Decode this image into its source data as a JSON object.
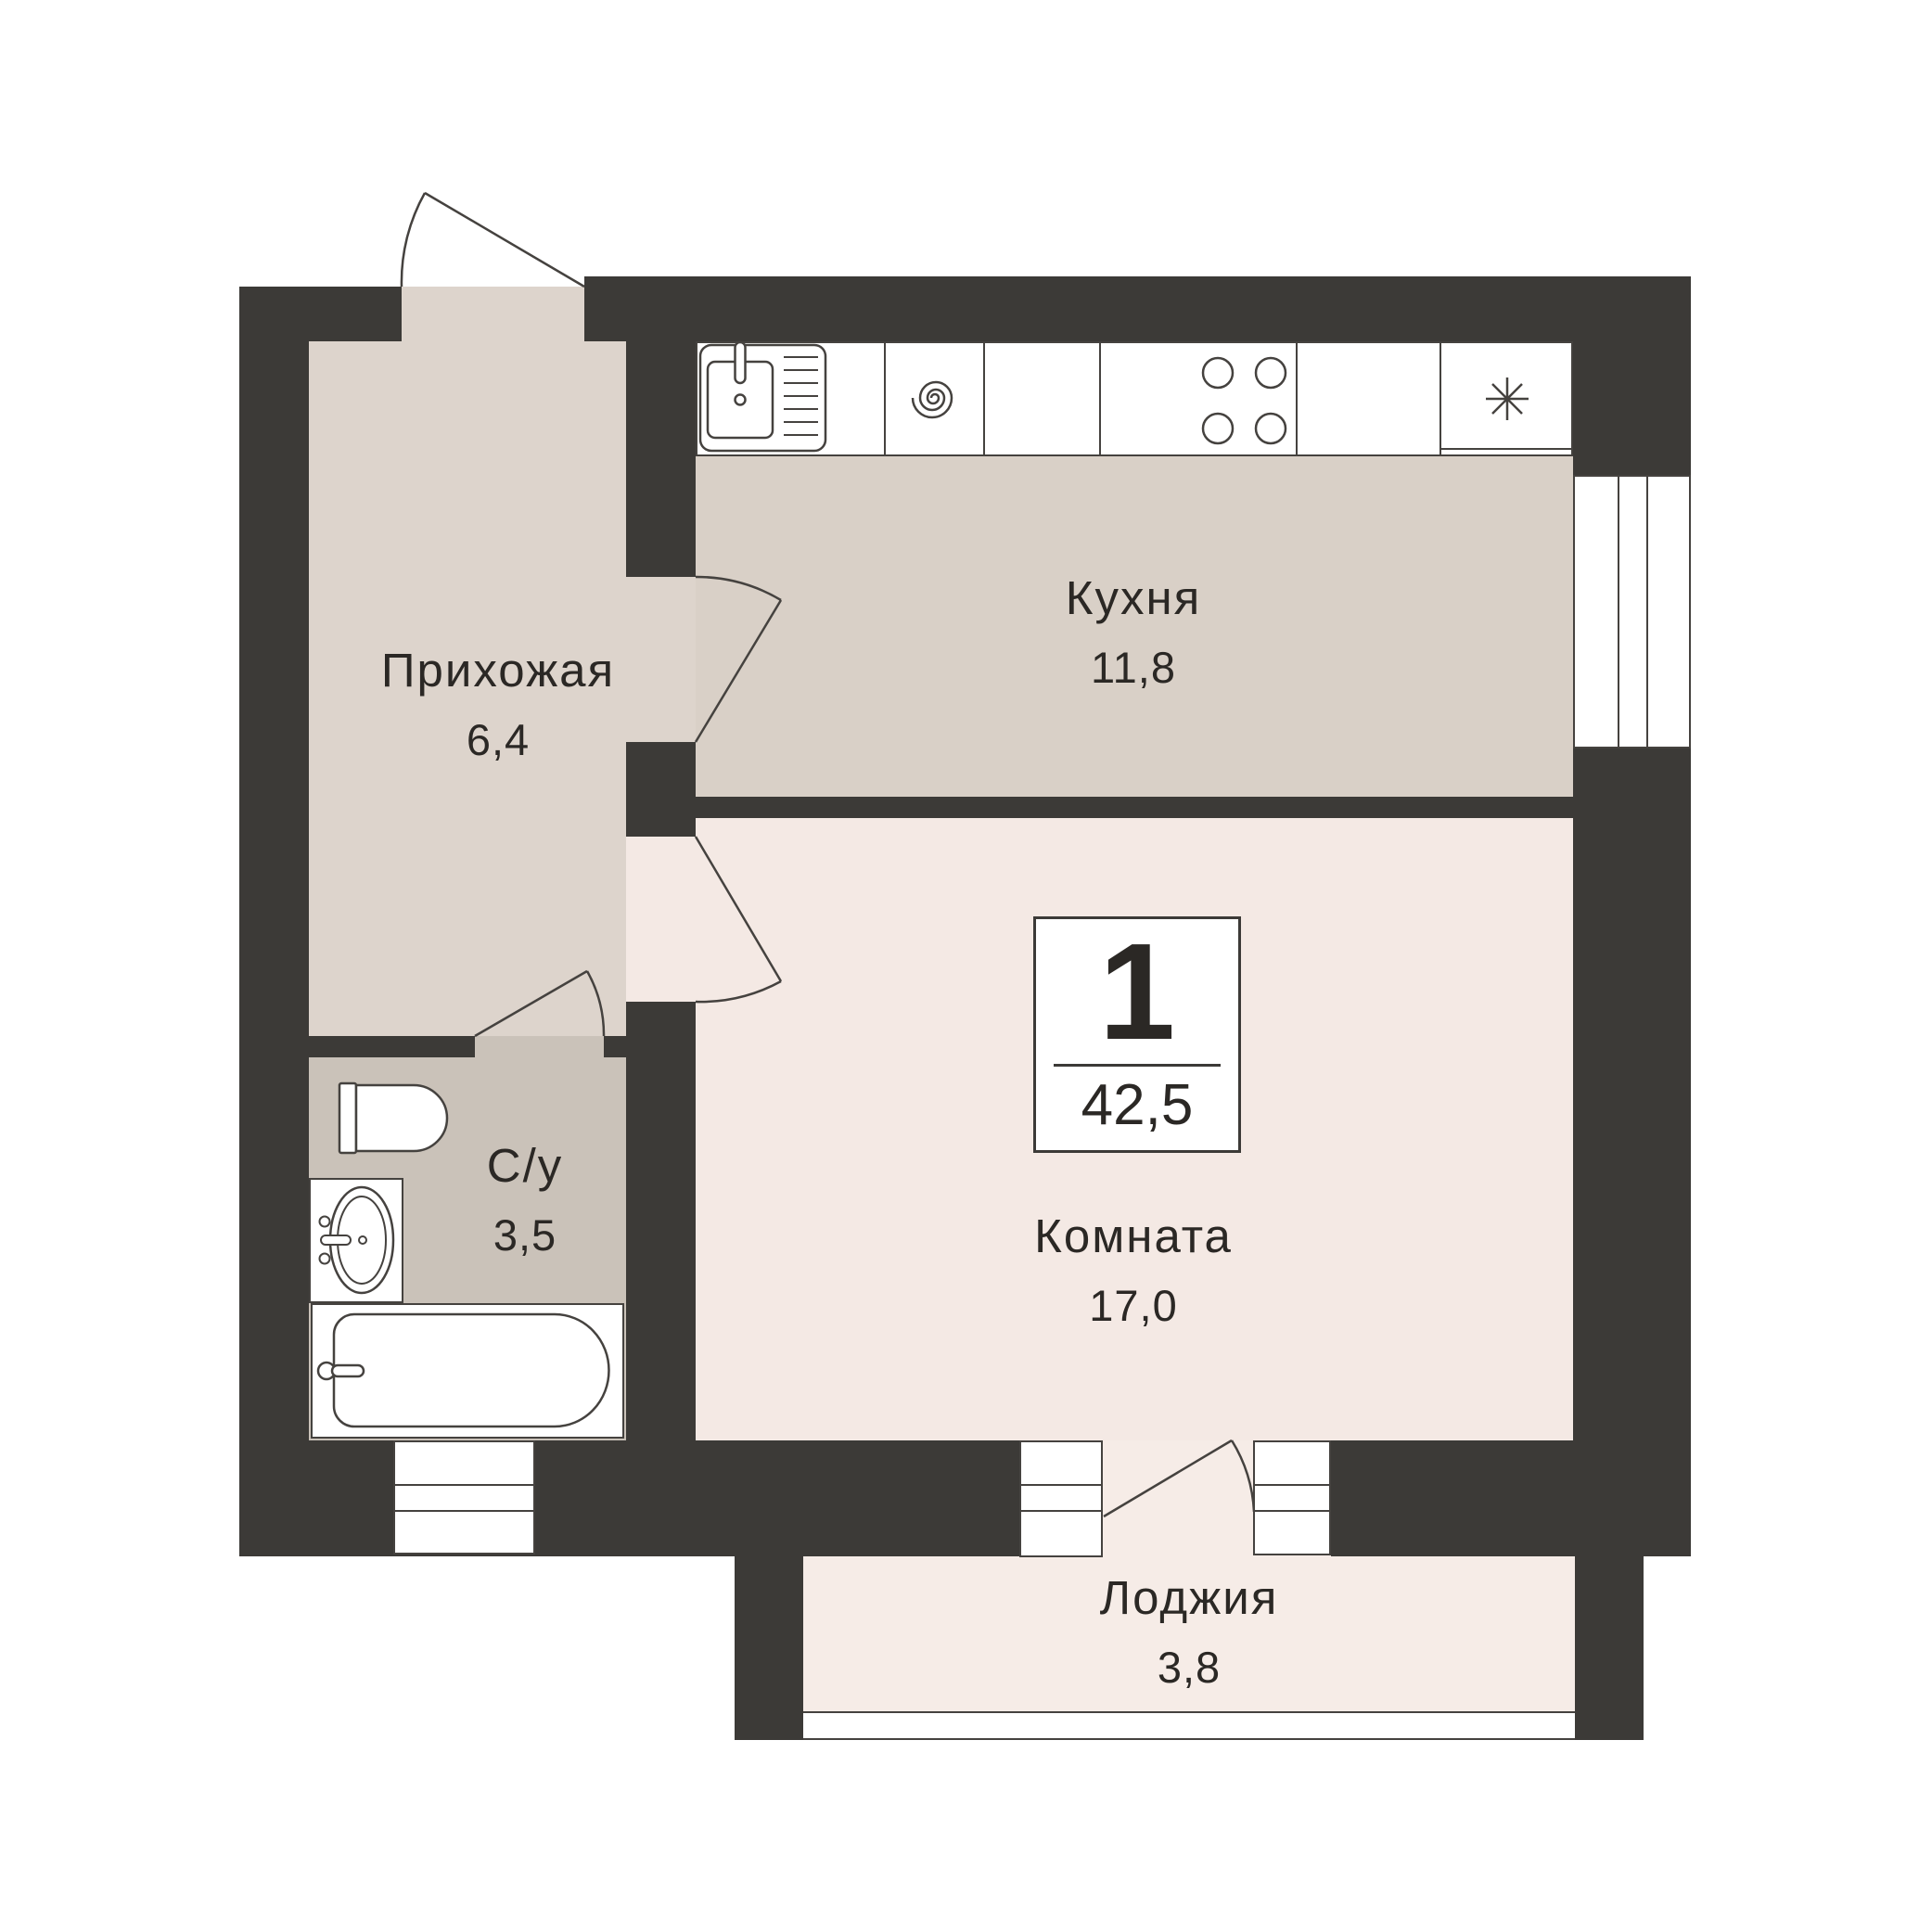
{
  "badge": {
    "rooms_count": "1",
    "total_area": "42,5"
  },
  "rooms": {
    "hallway": {
      "name": "Прихожая",
      "area": "6,4"
    },
    "kitchen": {
      "name": "Кухня",
      "area": "11,8"
    },
    "bathroom": {
      "name": "С/у",
      "area": "3,5"
    },
    "living_room": {
      "name": "Комната",
      "area": "17,0"
    },
    "loggia": {
      "name": "Лоджия",
      "area": "3,8"
    }
  },
  "icons": {
    "sink": "kitchen-sink-with-drainer",
    "washing_machine": "spiral-drum",
    "stove": "four-burner-hob",
    "fridge": "snowflake-asterisk",
    "toilet": "toilet-top-view",
    "washbasin": "oval-basin-with-taps",
    "bathtub": "bathtub-top-view"
  },
  "colors": {
    "wall": "#3c3a37",
    "stroke": "#45423f",
    "text": "#2b2825",
    "background": "#ffffff",
    "hallway_floor": "#ddd4cc",
    "kitchen_floor": "#d9d0c7",
    "bathroom_floor": "#cac2b9",
    "room_floor": "#f4e9e4",
    "loggia_floor": "#f6ece7"
  }
}
